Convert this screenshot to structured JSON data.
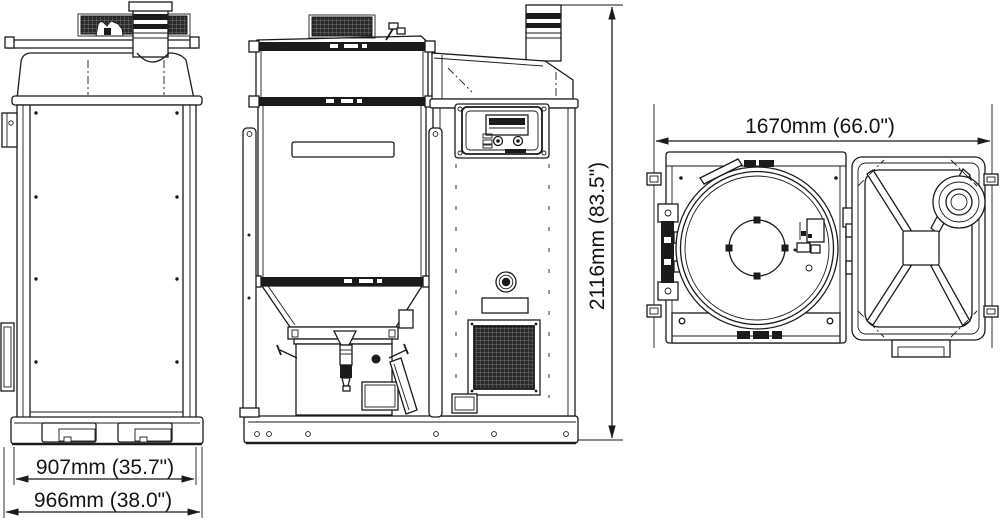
{
  "dimensions": {
    "side_view": {
      "inner_width": "907mm (35.7\")",
      "outer_width": "966mm (38.0\")"
    },
    "front_view": {
      "overall_height": "2116mm (83.5\")"
    },
    "top_view": {
      "overall_width": "1670mm (66.0\")"
    }
  },
  "colors": {
    "line": "#1b1b1b",
    "background": "#ffffff"
  }
}
